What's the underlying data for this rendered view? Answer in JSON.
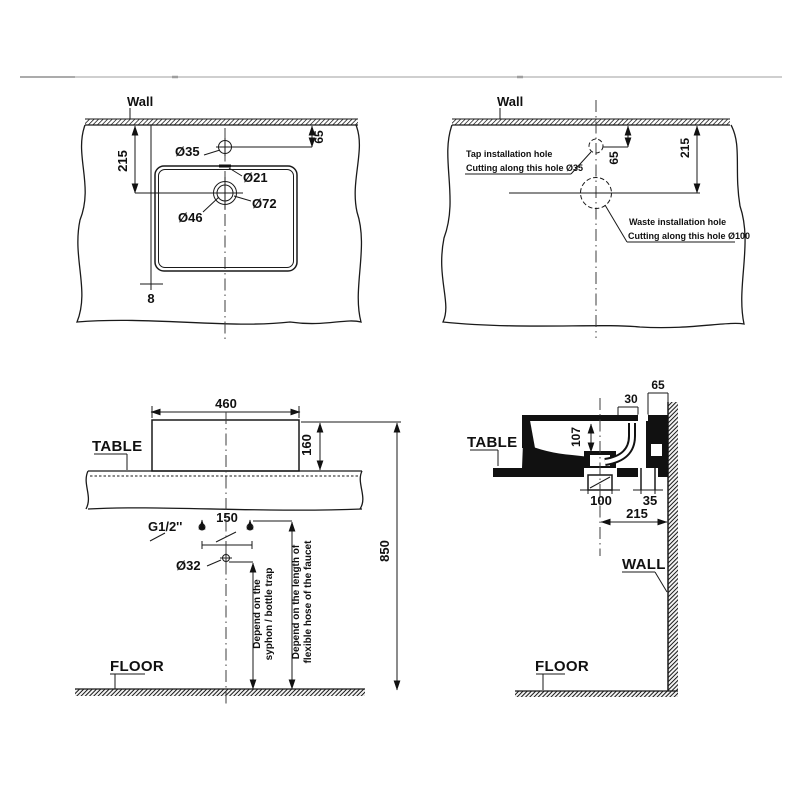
{
  "palette": {
    "line": "#1a1a1a",
    "background": "#ffffff",
    "separator": "#cccccc"
  },
  "top_left_view": {
    "wall_label": "Wall",
    "dim_wall_to_drain": "215",
    "dim_wall_to_tap": "65",
    "tap_hole_dia": "Ø35",
    "overflow_dia": "Ø21",
    "drain_outer_dia": "Ø72",
    "drain_inner_dia": "Ø46",
    "dim_edge_gap": "8"
  },
  "top_right_view": {
    "wall_label": "Wall",
    "dim_wall_to_tap": "65",
    "dim_wall_to_waste": "215",
    "tap_note_line1": "Tap installation hole",
    "tap_note_line2": "Cutting along this hole Ø35",
    "waste_note_line1": "Waste installation hole",
    "waste_note_line2": "Cutting along this hole Ø100"
  },
  "bottom_left_view": {
    "table_label": "TABLE",
    "floor_label": "FLOOR",
    "dim_basin_width": "460",
    "dim_basin_height": "160",
    "dim_supply_spacing": "150",
    "supply_thread": "G1/2''",
    "drain_pipe_dia": "Ø32",
    "dim_rim_to_floor": "850",
    "syphon_note_line1": "Depend on the",
    "syphon_note_line2": "syphon / bottle trap",
    "hose_note_line1": "Depend on the length of",
    "hose_note_line2": "flexible hose of the faucet"
  },
  "bottom_right_view": {
    "table_label": "TABLE",
    "wall_label": "WALL",
    "floor_label": "FLOOR",
    "dim_tap_to_wall": "65",
    "dim_tap_hole": "30",
    "dim_bowl_depth": "107",
    "dim_drain_width": "100",
    "dim_pipe_gap": "35",
    "dim_center_to_wall": "215"
  }
}
